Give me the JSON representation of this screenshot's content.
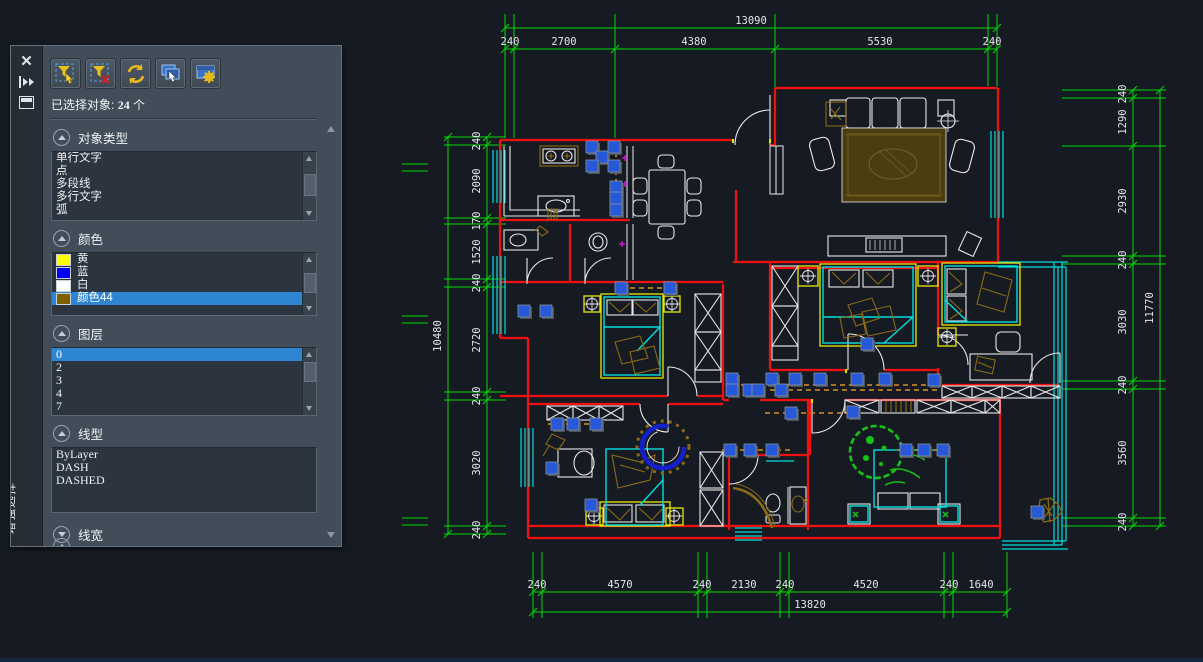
{
  "panel": {
    "tab_label": "增强选择",
    "toolbar_icons": [
      "filter-select-icon",
      "filter-clear-icon",
      "reselect-icon",
      "select-window-icon",
      "selection-settings-icon"
    ],
    "status": {
      "label": "已选择对象:",
      "count": "24",
      "suffix": "个"
    },
    "sections": [
      {
        "id": "object-type",
        "label": "对象类型",
        "collapsed": false,
        "items": [
          {
            "label": "单行文字"
          },
          {
            "label": "点"
          },
          {
            "label": "多段线"
          },
          {
            "label": "多行文字"
          },
          {
            "label": "弧"
          }
        ]
      },
      {
        "id": "color",
        "label": "颜色",
        "collapsed": false,
        "items": [
          {
            "label": "黄",
            "swatch": "#ffff00"
          },
          {
            "label": "蓝",
            "swatch": "#0000ff"
          },
          {
            "label": "白",
            "swatch": "#ffffff"
          },
          {
            "label": "颜色44",
            "swatch": "#7f5f00"
          }
        ],
        "selected": "颜色44"
      },
      {
        "id": "layer",
        "label": "图层",
        "collapsed": false,
        "items": [
          {
            "label": "0"
          },
          {
            "label": "2"
          },
          {
            "label": "3"
          },
          {
            "label": "4"
          },
          {
            "label": "7"
          }
        ],
        "selected": "0"
      },
      {
        "id": "linetype",
        "label": "线型",
        "collapsed": false,
        "items": [
          {
            "label": "ByLayer"
          },
          {
            "label": "DASH"
          },
          {
            "label": "DASHED"
          }
        ]
      },
      {
        "id": "lineweight",
        "label": "线宽",
        "collapsed": true,
        "items": []
      }
    ]
  },
  "drawing": {
    "dimensions": {
      "top": {
        "overall": "13090",
        "segments": [
          "240",
          "2700",
          "4380",
          "5530",
          "240"
        ]
      },
      "bottom": {
        "overall": "13820",
        "segments": [
          "240",
          "4570",
          "240",
          "2130",
          "240",
          "4520",
          "240",
          "1640"
        ]
      },
      "left": {
        "overall": "10480",
        "segments": [
          "240",
          "2090",
          "170",
          "1520",
          "240",
          "2720",
          "240",
          "3020",
          "240"
        ]
      },
      "right": {
        "overall": "11770",
        "segments": [
          "240",
          "1290",
          "2930",
          "240",
          "3030",
          "240",
          "3560",
          "240"
        ]
      }
    },
    "grips": [
      [
        592,
        147
      ],
      [
        614,
        147
      ],
      [
        602,
        157
      ],
      [
        592,
        166
      ],
      [
        614,
        166
      ],
      [
        616,
        187
      ],
      [
        616,
        198
      ],
      [
        616,
        210
      ],
      [
        621,
        288
      ],
      [
        670,
        288
      ],
      [
        524,
        311
      ],
      [
        546,
        311
      ],
      [
        732,
        379
      ],
      [
        732,
        390
      ],
      [
        749,
        390
      ],
      [
        758,
        390
      ],
      [
        772,
        379
      ],
      [
        781,
        390
      ],
      [
        795,
        379
      ],
      [
        820,
        379
      ],
      [
        857,
        379
      ],
      [
        885,
        379
      ],
      [
        934,
        380
      ],
      [
        791,
        413
      ],
      [
        853,
        412
      ],
      [
        867,
        344
      ],
      [
        557,
        424
      ],
      [
        573,
        424
      ],
      [
        596,
        424
      ],
      [
        552,
        468
      ],
      [
        591,
        505
      ],
      [
        730,
        450
      ],
      [
        750,
        450
      ],
      [
        772,
        450
      ],
      [
        906,
        450
      ],
      [
        924,
        450
      ],
      [
        943,
        450
      ],
      [
        1037,
        512
      ]
    ],
    "colors": {
      "wall": "#f01010",
      "window": "#00dede",
      "dimension": "#00d800",
      "furniture": "#e8e8e8",
      "wood": "#8a6a14",
      "grip": "#2658d8",
      "selection_dash": "#c2801e",
      "highlight": "#e8e800",
      "plant": "#16c416",
      "arc_blue": "#1420cc",
      "magenta": "#e814e8"
    }
  }
}
